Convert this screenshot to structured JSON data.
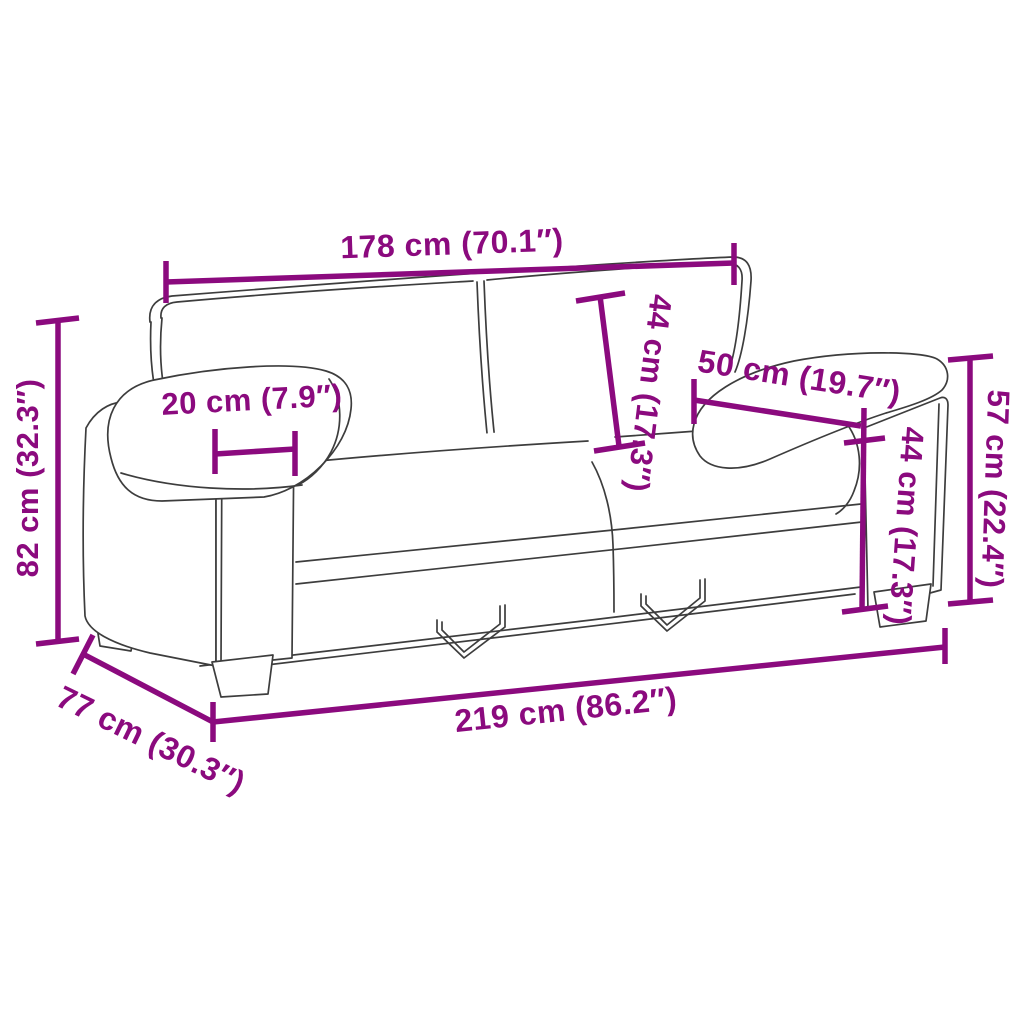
{
  "diagram": {
    "title": "Sofa dimensions diagram",
    "product": "2-seater sofa line drawing",
    "accent_color": "#8B0A7E",
    "outline_color": "#3D3D3D",
    "background_color": "#FFFFFF",
    "measurements": {
      "overall_width_top": "178 cm (70.1″)",
      "backrest_cushion_height": "44 cm (17.3″)",
      "armrest_length": "50 cm (19.7″)",
      "arm_height_right": "57 cm (22.4″)",
      "seat_back_height_right": "44 cm (17.3″)",
      "armrest_width": "20 cm (7.9″)",
      "overall_height": "82 cm (32.3″)",
      "depth": "77 cm (30.3″)",
      "overall_width_bottom": "219 cm (86.2″)"
    }
  }
}
